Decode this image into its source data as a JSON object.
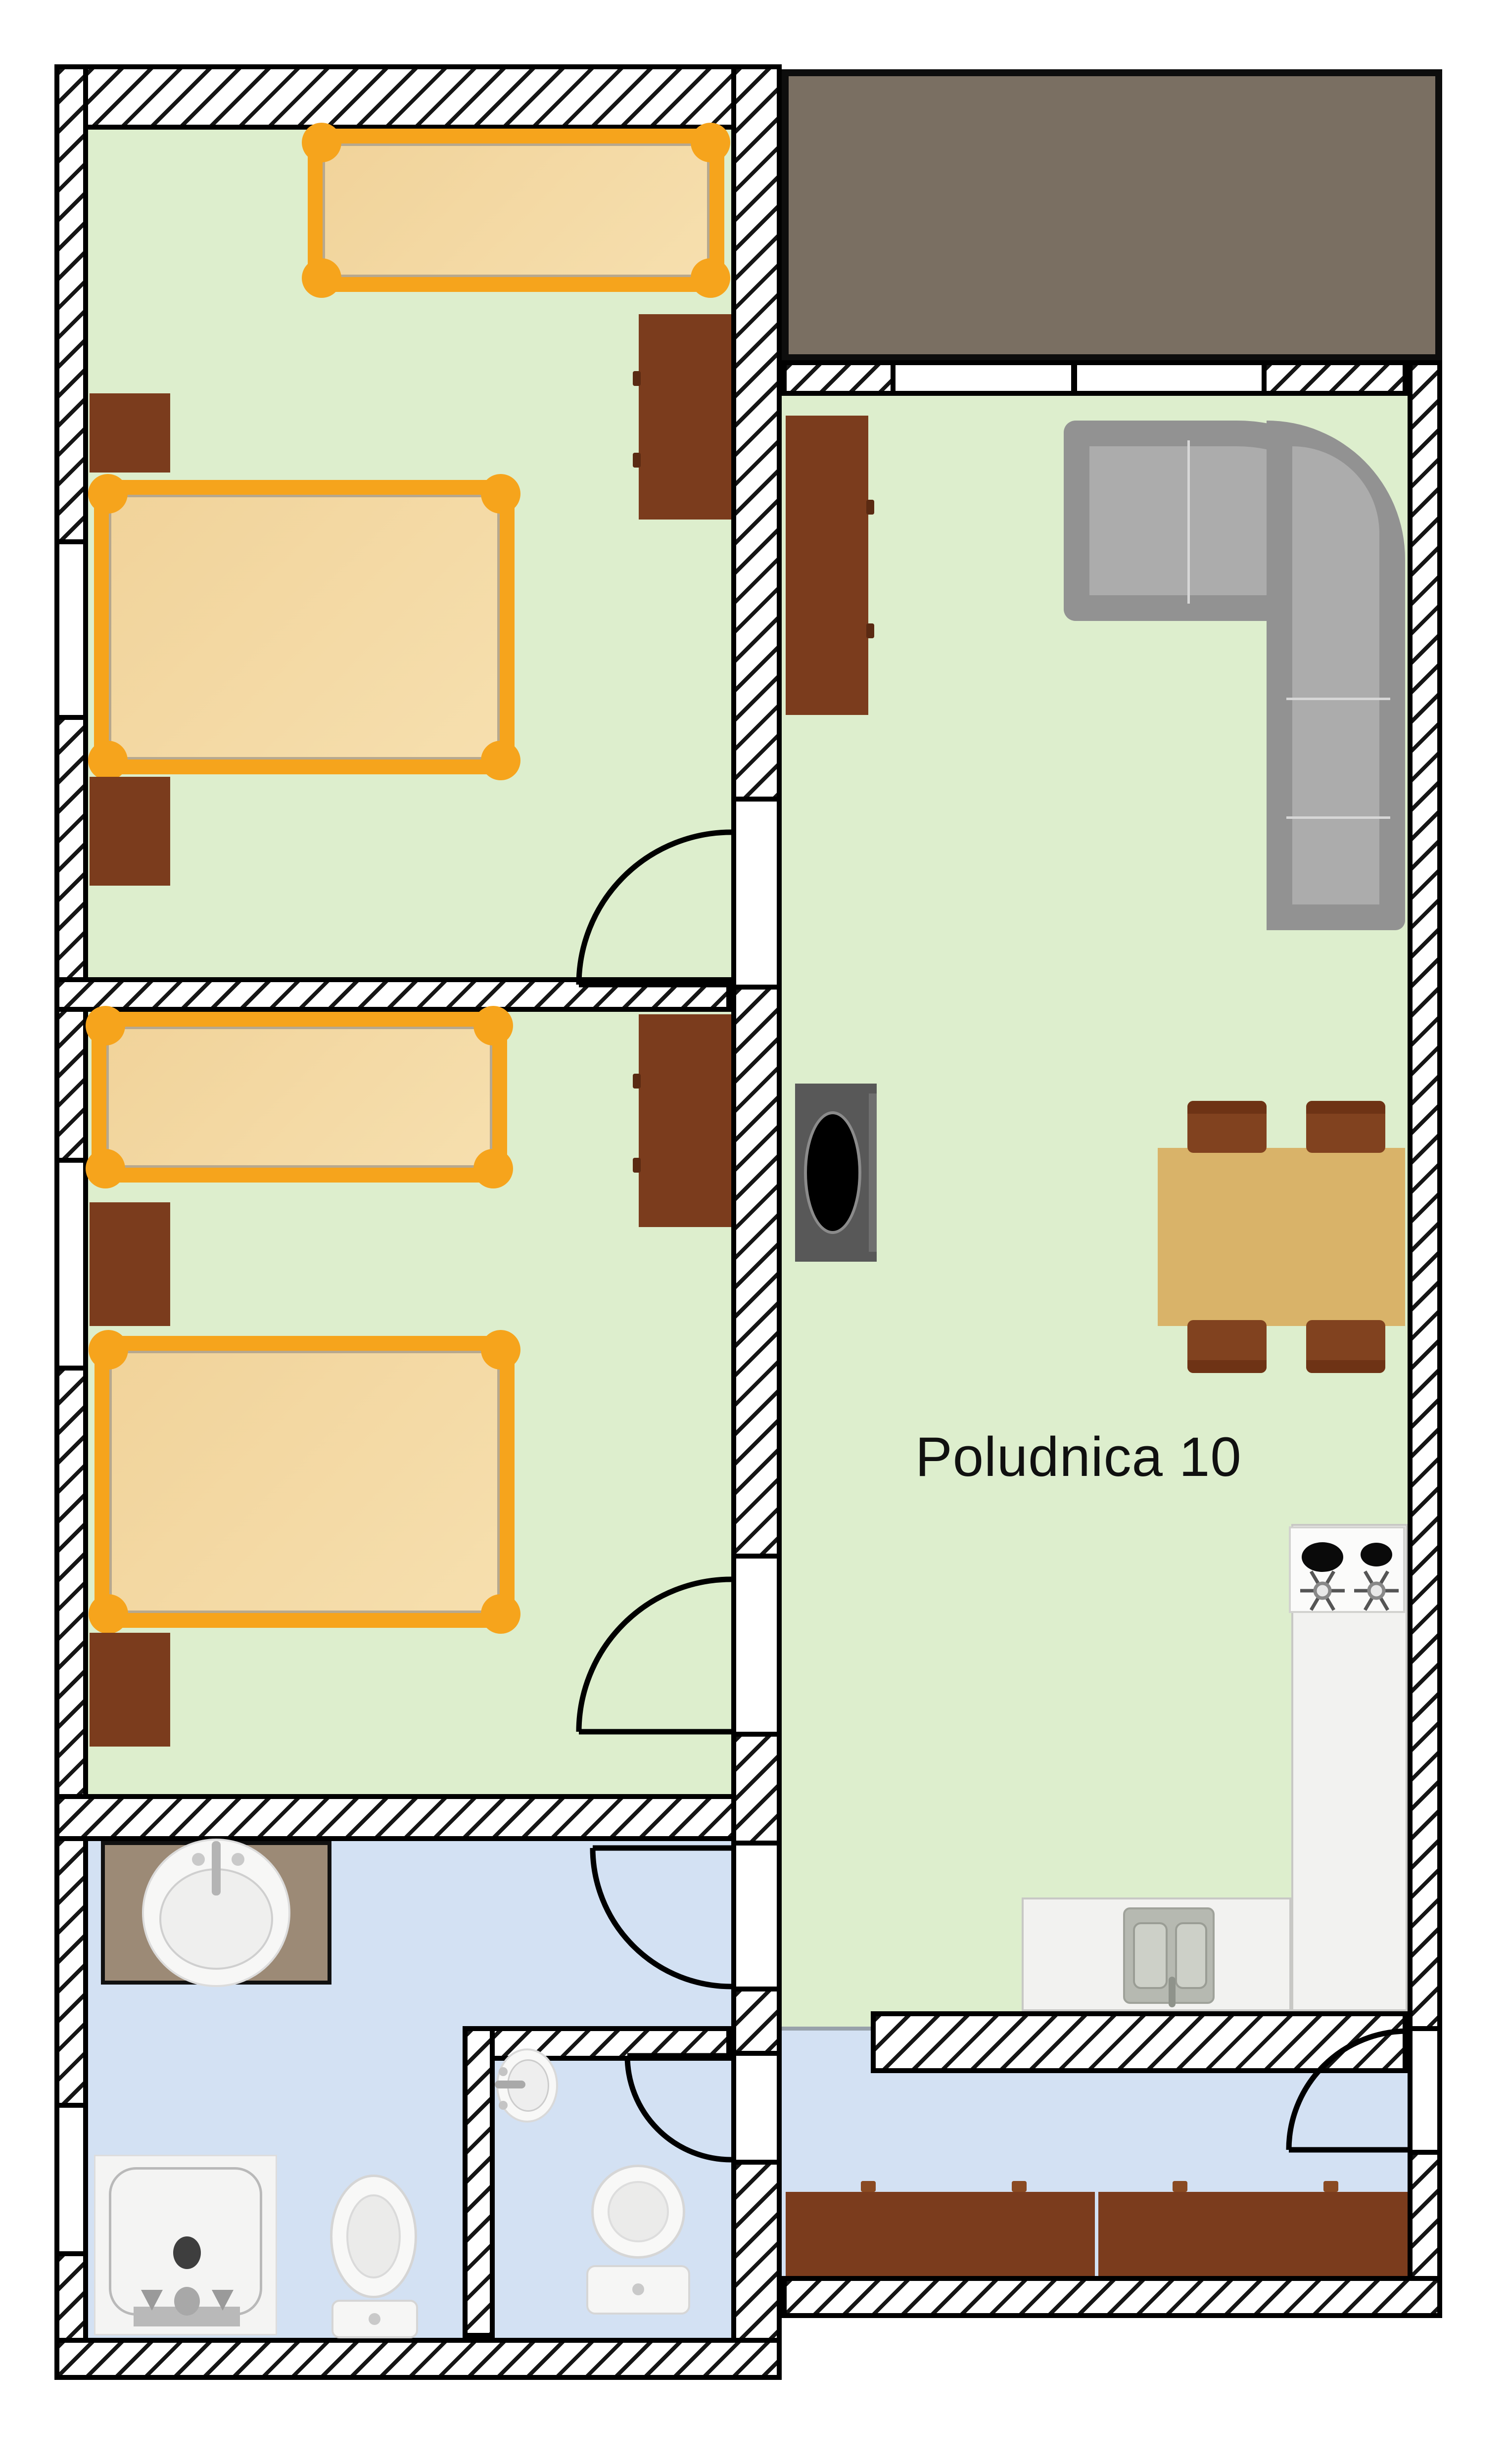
{
  "plan": {
    "label": "Poludnica 10"
  },
  "colors": {
    "room_floor_green": "#ddeecd",
    "wet_floor_blue": "#d3e1f3",
    "bed_frame_orange": "#f6a41c",
    "mattress_tan": "#f3d8a2",
    "furniture_brown": "#7b3c1d",
    "chair_brown": "#81421f",
    "terrace_gray_brown": "#7a6f62",
    "sofa_gray": "#acacac",
    "table_tan": "#d9b369",
    "stove_dark": "#585858",
    "counter_white": "#f2f2f0",
    "wall_line_black": "#000000"
  }
}
